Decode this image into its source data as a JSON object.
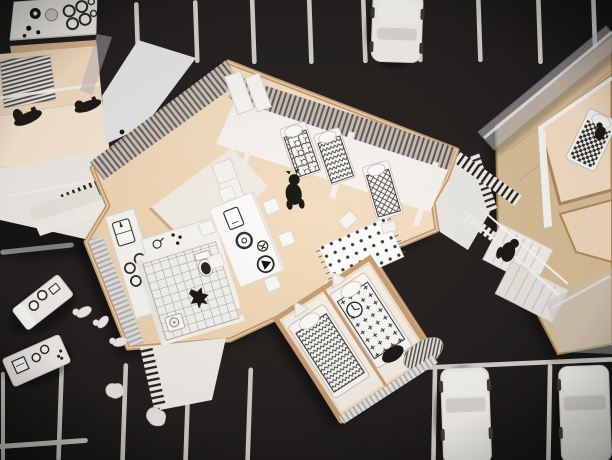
{
  "scene": {
    "type": "photograph",
    "subject": "architectural scale model, top-down view",
    "elements": {
      "ground": "black parking-lot board with white bay stripes",
      "center_apartment": "open-plan flat model: bedrooms with patterned beds, kitchen counters, tiled bathroom, dining table with printed tableware, polka-dot rug",
      "left_building": "neighbouring flat: kitchenette block, striped rug, white stairs and walkways, two dark miniature mopeds",
      "right_building": "neighbouring block: plywood walls, stairways, clear acrylic roof sheets, checkered bed",
      "cars": "three folded white paper cars parked in bays",
      "figures": "small dark miniatures: dog in bedroom, cat in bathroom, person on stairs",
      "loose_pieces": "spare white furniture cut-outs, tiny white figures and crumpled paper scraps on the asphalt"
    }
  },
  "palette": {
    "asphalt": "#23201e",
    "stripe": "#e4e1db",
    "floor_beige": "#f4dcbf",
    "floor_light": "#f9ead4",
    "wood_rim": "#c89e72",
    "plywood": "#d8bf99",
    "paper_white": "#f2efe9",
    "paper_bright": "#fbfaf7",
    "pattern_ink": "#3c3934",
    "acrylic_grey": "#c8c6c8",
    "corrugate_dark": "#5a544e",
    "figure_black": "#1d1a17",
    "tile_line": "#908c85"
  }
}
